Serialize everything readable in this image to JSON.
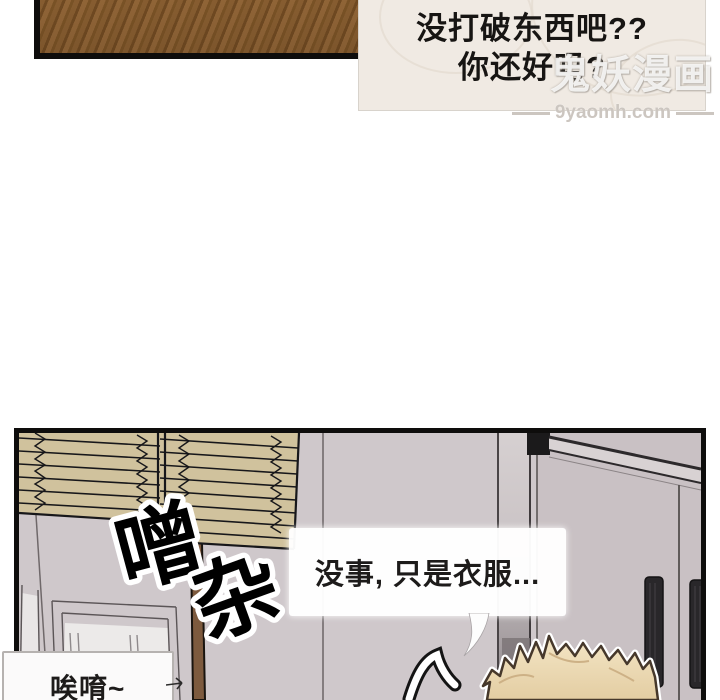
{
  "watermark": {
    "site_name": "鬼妖漫画",
    "site_url": "9yaomh.com"
  },
  "top_panel": {
    "bubble_line1": "没打破东西吧??",
    "bubble_line2": "你还好吗?"
  },
  "bottom_panel": {
    "sfx_char1": "噌",
    "sfx_char2": "杂",
    "bubble_right": "没事, 只是衣服...",
    "bubble_left": "唉唷~"
  },
  "colors": {
    "panel_border": "#0e0d0c",
    "wood_brown": "#8c6133",
    "blind_tan": "#d0c29d",
    "wall_gray": "#cfc8cb",
    "door_gray": "#c9c1c4",
    "handle_dark": "#29272a",
    "pole_brown": "#7d5a3e",
    "hair_blond": "#eedcba",
    "bubble_cream": "#f0eae3"
  }
}
